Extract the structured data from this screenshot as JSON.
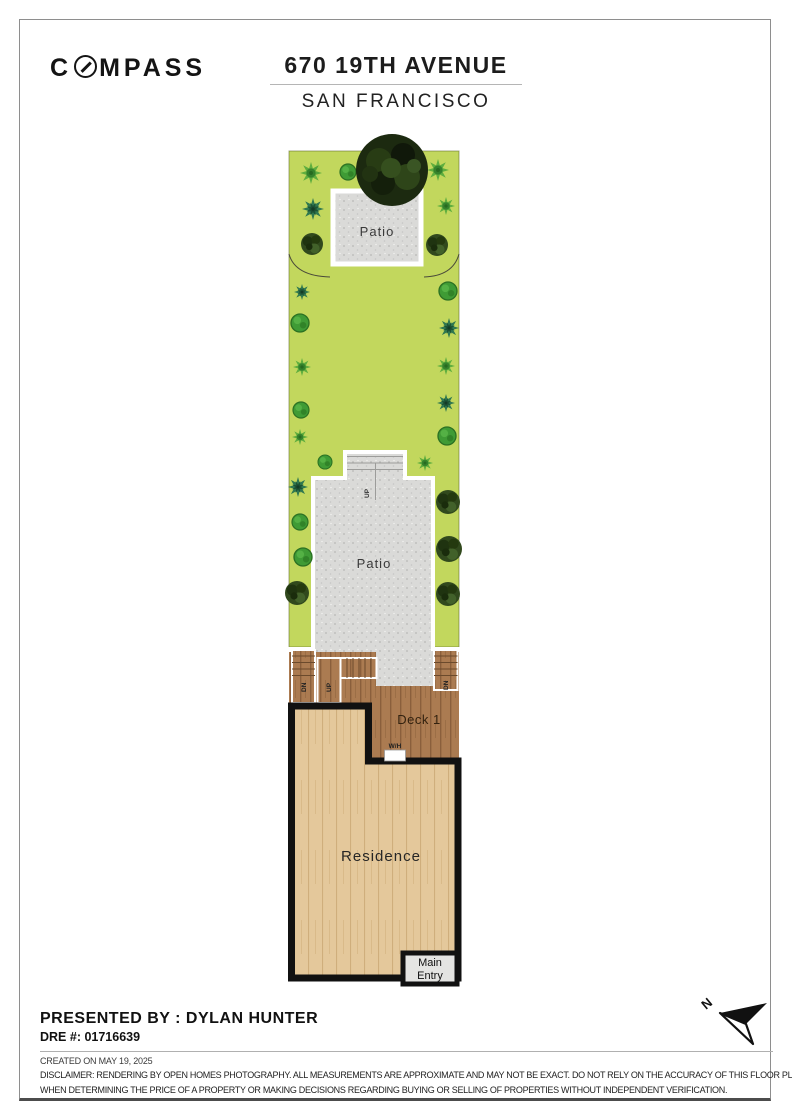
{
  "header": {
    "logo_prefix": "C",
    "logo_suffix": "MPASS",
    "title": "670 19TH AVENUE",
    "subtitle": "SAN FRANCISCO"
  },
  "plan": {
    "labels": {
      "patio_top": "Patio",
      "patio_mid": "Patio",
      "deck": "Deck 1",
      "residence": "Residence",
      "main_entry_line1": "Main",
      "main_entry_line2": "Entry",
      "water_heater": "W/H",
      "up": "UP",
      "down": "DN",
      "north": "N"
    },
    "colors": {
      "lawn": "#c2d75d",
      "patio": "#dadad8",
      "deck": "#ab7b51",
      "residence_floor": "#e4c89b",
      "wall": "#111111"
    }
  },
  "footer": {
    "presented_by": "PRESENTED BY : DYLAN HUNTER",
    "dre": "DRE #: 01716639",
    "created": "CREATED ON MAY 19, 2025",
    "disclaimer_line1": "DISCLAIMER: RENDERING BY OPEN HOMES PHOTOGRAPHY. ALL MEASUREMENTS ARE APPROXIMATE AND MAY NOT BE EXACT. DO NOT RELY ON THE ACCURACY OF THIS FLOOR PLAN",
    "disclaimer_line2": "WHEN DETERMINING THE PRICE OF A PROPERTY OR MAKING DECISIONS REGARDING BUYING OR SELLING OF PROPERTIES WITHOUT INDEPENDENT VERIFICATION."
  }
}
